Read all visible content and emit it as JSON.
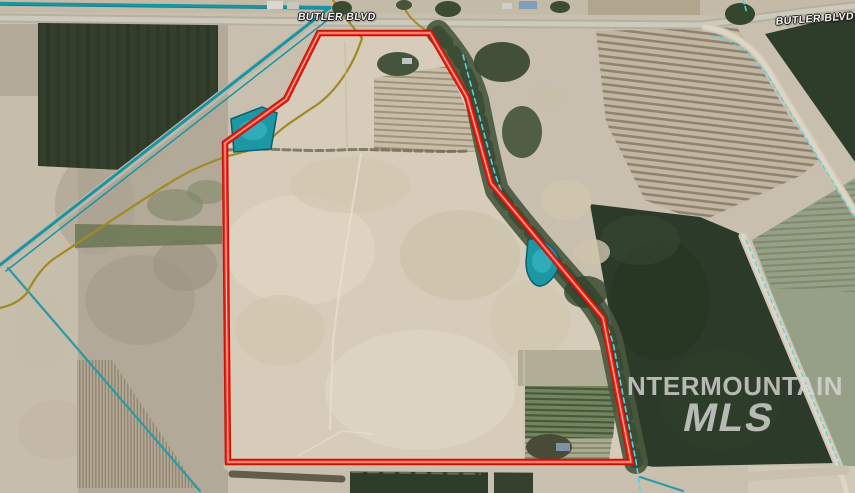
{
  "map": {
    "width": 855,
    "height": 493,
    "road_labels": [
      {
        "text": "BUTLER BLVD",
        "position": "north-west"
      },
      {
        "text": "BUTLER BLVD",
        "position": "north-east"
      }
    ],
    "watermark": {
      "line1": "NTERMOUNTAIN",
      "line2": "MLS"
    },
    "palette": {
      "boundary_red": "#f02718",
      "boundary_red_dark": "#c3140a",
      "boundary_core_light": "#ffcabe",
      "canal_teal": "#1795a3",
      "pond_fill": "#1e97a4",
      "pond_edge": "#0a5f6d",
      "ditch_olive": "#a08a26",
      "creek_dash_cyan": "#55cfe2",
      "parcel_tan": "#d6ccb9",
      "scrub_tan": "#b2a998",
      "dark_field_green": "#2c3a29",
      "road_gray": "#b5b0a2",
      "watermark_gray": "#d6d6d3"
    },
    "boundary": {
      "points": "319,33 430,33 467,97 491,183 603,318 631,462 228,462 225,143 286,99",
      "outer": "#c3140a",
      "mid": "#f02718",
      "core": "#ffcabe"
    },
    "layers": [
      {
        "name": "base-ground",
        "kind": "polygon",
        "points": "0,0 855,0 855,493 0,493",
        "fill": "#c9bfae"
      },
      {
        "name": "scrub-west",
        "kind": "polygon",
        "points": "0,24 228,24 228,493 0,493",
        "fill": "#b2a998"
      },
      {
        "name": "west-smooth-strip",
        "kind": "polygon",
        "points": "0,96 78,96 78,493 0,493",
        "fill": "#c8bfad",
        "opacity": 0.9
      },
      {
        "name": "scrub-mottle",
        "kind": "ellipse",
        "cx": 140,
        "cy": 300,
        "rx": 55,
        "ry": 45,
        "fill": "#a69d8c",
        "opacity": 0.7
      },
      {
        "name": "scrub-mottle",
        "kind": "ellipse",
        "cx": 95,
        "cy": 205,
        "rx": 40,
        "ry": 50,
        "fill": "#aaa190",
        "opacity": 0.6
      },
      {
        "name": "scrub-mottle",
        "kind": "ellipse",
        "cx": 185,
        "cy": 265,
        "rx": 32,
        "ry": 26,
        "fill": "#9b927e",
        "opacity": 0.6
      },
      {
        "name": "scrub-mottle",
        "kind": "ellipse",
        "cx": 55,
        "cy": 430,
        "rx": 38,
        "ry": 30,
        "fill": "#c2b8a4",
        "opacity": 0.7
      },
      {
        "name": "scrub-mottle",
        "kind": "ellipse",
        "cx": 120,
        "cy": 145,
        "rx": 42,
        "ry": 30,
        "fill": "#b0a795",
        "opacity": 0.7
      },
      {
        "name": "scrub-mottle",
        "kind": "ellipse",
        "cx": 40,
        "cy": 330,
        "rx": 30,
        "ry": 40,
        "fill": "#c4bba8",
        "opacity": 0.6
      },
      {
        "name": "top-strip",
        "kind": "polygon",
        "points": "0,0 855,0 855,16 0,12",
        "fill": "#c3baa8"
      },
      {
        "name": "top-farm-field",
        "kind": "polygon",
        "points": "588,0 700,0 700,15 588,15",
        "fill": "#b1a58d"
      },
      {
        "name": "field-upper-left-dark",
        "kind": "polygon",
        "points": "38,23 218,23 218,92 122,170 38,166",
        "fill": "#333f2d"
      },
      {
        "name": "field-upper-left-streaks",
        "kind": "stripes",
        "clip": "38,23 218,23 218,92 122,170 38,166",
        "dir": "v",
        "pitch": 10,
        "slope": 0,
        "color": "#27331f",
        "width": 3,
        "opacity": 0.5
      },
      {
        "name": "field-ne-triangle",
        "kind": "polygon",
        "points": "765,34 855,13 855,162",
        "fill": "#2e3c2a"
      },
      {
        "name": "field-ne-striped",
        "kind": "polygon",
        "points": "596,31 737,27 790,118 822,158 800,176 700,222 645,200 606,122",
        "fill": "#c3b6a0"
      },
      {
        "name": "field-ne-furrows",
        "kind": "stripes",
        "clip": "596,31 737,27 790,118 822,158 800,176 700,222 645,200 606,122",
        "dir": "h",
        "pitch": 7,
        "slope": 0.12,
        "color": "#7b7261",
        "width": 2.5,
        "opacity": 0.75
      },
      {
        "name": "field-east-green",
        "kind": "polygon",
        "points": "752,240 855,178 855,493 847,493",
        "fill": "#96a087"
      },
      {
        "name": "field-east-furrows",
        "kind": "stripes",
        "clip": "752,240 855,180 855,292 772,288",
        "dir": "h",
        "pitch": 6,
        "slope": -0.05,
        "color": "#6e7a5e",
        "width": 2,
        "opacity": 0.6
      },
      {
        "name": "field-center-green",
        "kind": "polygon",
        "points": "590,204 700,217 745,236 838,463 643,467 613,333",
        "fill": "#2c3a29"
      },
      {
        "name": "green-mottle",
        "kind": "ellipse",
        "cx": 660,
        "cy": 300,
        "rx": 50,
        "ry": 60,
        "fill": "#243320",
        "opacity": 0.5
      },
      {
        "name": "green-mottle",
        "kind": "ellipse",
        "cx": 720,
        "cy": 400,
        "rx": 60,
        "ry": 50,
        "fill": "#31402c",
        "opacity": 0.6
      },
      {
        "name": "green-mottle",
        "kind": "ellipse",
        "cx": 640,
        "cy": 240,
        "rx": 40,
        "ry": 25,
        "fill": "#3a4a33",
        "opacity": 0.5
      },
      {
        "name": "parcel-interior",
        "kind": "polygon",
        "points": "319,33 430,33 467,97 491,183 603,318 631,462 228,462 225,143 286,99",
        "fill": "#d6ccb9"
      },
      {
        "name": "parcel-mottle",
        "kind": "ellipse",
        "cx": 300,
        "cy": 250,
        "rx": 75,
        "ry": 55,
        "fill": "#ded5c2",
        "opacity": 0.8
      },
      {
        "name": "parcel-mottle",
        "kind": "ellipse",
        "cx": 420,
        "cy": 390,
        "rx": 95,
        "ry": 60,
        "fill": "#ded5c3",
        "opacity": 0.7
      },
      {
        "name": "parcel-mottle",
        "kind": "ellipse",
        "cx": 460,
        "cy": 255,
        "rx": 60,
        "ry": 45,
        "fill": "#ccc1aa",
        "opacity": 0.7
      },
      {
        "name": "parcel-mottle",
        "kind": "ellipse",
        "cx": 350,
        "cy": 185,
        "rx": 60,
        "ry": 28,
        "fill": "#d0c5ae",
        "opacity": 0.6
      },
      {
        "name": "parcel-mottle",
        "kind": "ellipse",
        "cx": 280,
        "cy": 330,
        "rx": 45,
        "ry": 35,
        "fill": "#cfc4ad",
        "opacity": 0.6
      },
      {
        "name": "parcel-mottle",
        "kind": "ellipse",
        "cx": 530,
        "cy": 320,
        "rx": 40,
        "ry": 40,
        "fill": "#d1c6af",
        "opacity": 0.6
      },
      {
        "name": "parcel-subfield-ne",
        "kind": "polygon",
        "points": "374,78 448,66 484,152 374,152",
        "fill": "#c9bda7"
      },
      {
        "name": "parcel-subfield-ne-furrows",
        "kind": "stripes",
        "clip": "374,78 448,66 484,152 374,152",
        "dir": "h",
        "pitch": 6,
        "slope": 0.05,
        "color": "#948a73",
        "width": 2,
        "opacity": 0.8
      },
      {
        "name": "parcel-subfield-se-gray",
        "kind": "polygon",
        "points": "518,350 612,350 616,386 518,386",
        "fill": "#b2ad96"
      },
      {
        "name": "parcel-subfield-se-green",
        "kind": "polygon",
        "points": "525,386 618,386 613,438 525,438",
        "fill": "#74845f"
      },
      {
        "name": "parcel-subfield-se-green-rows",
        "kind": "stripes",
        "clip": "525,386 618,386 613,438 525,438",
        "dir": "h",
        "pitch": 5.5,
        "slope": 0.02,
        "color": "#3f5236",
        "width": 2.2,
        "opacity": 0.85
      },
      {
        "name": "parcel-subfield-se-lower",
        "kind": "polygon",
        "points": "525,438 612,438 609,461 525,461",
        "fill": "#acaa90"
      },
      {
        "name": "parcel-subfield-se-lower-rows",
        "kind": "stripes",
        "clip": "525,438 612,438 609,461 525,461",
        "dir": "h",
        "pitch": 5,
        "slope": 0,
        "color": "#6d7a58",
        "width": 1.8,
        "opacity": 0.7
      },
      {
        "name": "field-sw-striped",
        "kind": "polygon",
        "points": "77,360 112,360 197,488 77,488",
        "fill": "#b6ab96"
      },
      {
        "name": "field-sw-rows",
        "kind": "stripes",
        "clip": "77,360 112,360 197,488 77,488",
        "dir": "v",
        "pitch": 3.2,
        "slope": 0,
        "color": "#847a66",
        "width": 1.4,
        "opacity": 0.8
      },
      {
        "name": "green-scrub-patch",
        "kind": "ellipse",
        "cx": 175,
        "cy": 205,
        "rx": 28,
        "ry": 16,
        "fill": "#7a8362",
        "opacity": 0.55
      },
      {
        "name": "green-scrub-patch",
        "kind": "ellipse",
        "cx": 207,
        "cy": 192,
        "rx": 20,
        "ry": 12,
        "fill": "#7a8362",
        "opacity": 0.5
      },
      {
        "name": "green-band-west",
        "kind": "polygon",
        "points": "75,224 222,226 222,244 75,248",
        "fill": "#66744f",
        "opacity": 0.8
      },
      {
        "name": "field-south-green-1",
        "kind": "polygon",
        "points": "350,468 488,468 488,493 350,493",
        "fill": "#2e3c2a"
      },
      {
        "name": "field-south-green-2",
        "kind": "polygon",
        "points": "494,469 533,469 533,493 494,493",
        "fill": "#33412e"
      },
      {
        "name": "farmstead-se-corner",
        "kind": "polygon",
        "points": "748,466 855,466 855,493 748,493",
        "fill": "#d1c8b5"
      },
      {
        "name": "butler-blvd-road",
        "kind": "path",
        "d": "M0,18 L330,22 L700,25 C760,18 810,10 855,6",
        "stroke": "#b5b0a2",
        "width": 9
      },
      {
        "name": "butler-blvd-road-center",
        "kind": "path",
        "d": "M0,18 L330,22 L700,25 C760,18 810,10 855,6",
        "stroke": "#cdc9bb",
        "width": 5
      },
      {
        "name": "canal-road-diagonal",
        "kind": "path",
        "d": "M328,10 L0,266",
        "stroke": "#bfb8aa",
        "width": 7
      },
      {
        "name": "road-ne",
        "kind": "path",
        "d": "M705,27 C735,32 758,50 773,78 L855,212",
        "stroke": "#cfc8b6",
        "width": 8
      },
      {
        "name": "road-ne-center",
        "kind": "path",
        "d": "M705,27 C735,32 758,50 773,78 L855,212",
        "stroke": "#ddd6c4",
        "width": 4.5
      },
      {
        "name": "road-east",
        "kind": "path",
        "d": "M743,236 L838,464 L847,493",
        "stroke": "#cfc8b6",
        "width": 9
      },
      {
        "name": "road-east-center",
        "kind": "path",
        "d": "M743,236 L838,464 L847,493",
        "stroke": "#ddd6c4",
        "width": 5
      },
      {
        "name": "road-south",
        "kind": "path",
        "d": "M228,466 L640,469 L700,480 L845,470",
        "stroke": "#c9c1ae",
        "width": 9
      },
      {
        "name": "road-south-tracks",
        "kind": "path",
        "d": "M352,472 L480,474",
        "stroke": "#857e6c",
        "width": 2,
        "dash": "10,6",
        "opacity": 0.7
      },
      {
        "name": "hedgerow-south",
        "kind": "path",
        "d": "M232,474 L342,479",
        "stroke": "#4f4a3b",
        "width": 7,
        "opacity": 0.85
      },
      {
        "name": "canal-north",
        "kind": "path",
        "d": "M0,5 L330,9",
        "stroke": "#0e7280",
        "width": 1.4
      },
      {
        "name": "canal-north-main",
        "kind": "path",
        "d": "M0,3.5 L330,7.5",
        "stroke": "#1795a3",
        "width": 3.2
      },
      {
        "name": "canal-diagonal-1",
        "kind": "path",
        "d": "M328,9 L0,265",
        "stroke": "#1795a3",
        "width": 3
      },
      {
        "name": "canal-diagonal-2",
        "kind": "path",
        "d": "M334,15 L6,271",
        "stroke": "#1795a3",
        "width": 1.5
      },
      {
        "name": "canal-branch-sw",
        "kind": "path",
        "d": "M8,268 L200,491",
        "stroke": "#2b9aa6",
        "width": 2.2
      },
      {
        "name": "ditch-olive-main",
        "kind": "path",
        "d": "M333,0 C342,14 352,26 362,38 C352,70 332,96 312,108 C296,119 282,127 270,140 C258,149 241,153 228,156 C207,163 186,172 168,184 C135,204 95,232 55,258 C40,268 32,284 26,294 C18,303 8,306 0,308",
        "stroke": "#a08a26",
        "width": 2.2
      },
      {
        "name": "ditch-olive-east",
        "kind": "path",
        "d": "M402,0 C404,12 412,20 420,26 C437,38 452,52 461,72 C468,88 472,102 475,116",
        "stroke": "#a08a26",
        "width": 2
      },
      {
        "name": "riparian-corridor",
        "kind": "path",
        "d": "M438,32 C458,55 470,75 477,100 C484,135 490,165 497,190 C520,222 556,262 584,294 C600,312 608,328 612,345 C620,385 628,425 636,462",
        "stroke": "#49593f",
        "width": 24,
        "opacity": 0.92
      },
      {
        "name": "riparian-texture",
        "kind": "path",
        "d": "M438,32 C458,55 470,75 477,100 C484,135 490,165 497,190 C520,222 556,262 584,294 C600,312 608,328 612,345 C620,385 628,425 636,462",
        "stroke": "#35452e",
        "width": 13,
        "dash": "14,11",
        "opacity": 0.7
      },
      {
        "name": "riparian-blob",
        "kind": "ellipse",
        "cx": 502,
        "cy": 62,
        "rx": 28,
        "ry": 20,
        "fill": "#33442c",
        "opacity": 0.9
      },
      {
        "name": "riparian-blob",
        "kind": "ellipse",
        "cx": 522,
        "cy": 132,
        "rx": 20,
        "ry": 26,
        "fill": "#3a4c33",
        "opacity": 0.85
      },
      {
        "name": "riparian-blob",
        "kind": "ellipse",
        "cx": 586,
        "cy": 292,
        "rx": 22,
        "ry": 16,
        "fill": "#33442c",
        "opacity": 0.8
      },
      {
        "name": "sand-gap",
        "kind": "ellipse",
        "cx": 566,
        "cy": 200,
        "rx": 26,
        "ry": 20,
        "fill": "#cfc5ae",
        "opacity": 0.9
      },
      {
        "name": "sand-gap",
        "kind": "ellipse",
        "cx": 592,
        "cy": 252,
        "rx": 18,
        "ry": 13,
        "fill": "#cfc5ae",
        "opacity": 0.8
      },
      {
        "name": "sand-gap",
        "kind": "ellipse",
        "cx": 547,
        "cy": 97,
        "rx": 15,
        "ry": 10,
        "fill": "#c8bea8",
        "opacity": 0.75
      },
      {
        "name": "trees-top",
        "kind": "ellipse",
        "cx": 342,
        "cy": 8,
        "rx": 10,
        "ry": 7,
        "fill": "#3c4c33"
      },
      {
        "name": "trees-top",
        "kind": "ellipse",
        "cx": 448,
        "cy": 9,
        "rx": 13,
        "ry": 8,
        "fill": "#3c4c33"
      },
      {
        "name": "trees-top",
        "kind": "ellipse",
        "cx": 560,
        "cy": 7,
        "rx": 10,
        "ry": 6,
        "fill": "#3c4c33"
      },
      {
        "name": "trees-top",
        "kind": "ellipse",
        "cx": 740,
        "cy": 14,
        "rx": 15,
        "ry": 11,
        "fill": "#35462f"
      },
      {
        "name": "trees-top",
        "kind": "ellipse",
        "cx": 404,
        "cy": 5,
        "rx": 8,
        "ry": 5,
        "fill": "#46543c"
      },
      {
        "name": "building-top",
        "kind": "polygon",
        "points": "267,1 283,1 283,9 267,9",
        "fill": "#d8d8d2"
      },
      {
        "name": "building-top",
        "kind": "polygon",
        "points": "287,2 299,2 299,9 287,9",
        "fill": "#c5c8c2"
      },
      {
        "name": "building-top-blue-roof",
        "kind": "polygon",
        "points": "519,1 537,1 537,9 519,9",
        "fill": "#7e9fba"
      },
      {
        "name": "building-top",
        "kind": "polygon",
        "points": "502,3 512,3 512,9 502,9",
        "fill": "#d0d0c8"
      },
      {
        "name": "creek-dashed",
        "kind": "path",
        "d": "M463,55 C472,90 482,125 489,152 C494,172 499,187 504,196 C530,228 560,262 586,294 C602,314 610,330 614,347 C621,386 629,427 636,461 L640,489",
        "stroke": "#55cfe2",
        "width": 1.6,
        "dash": "5,4"
      },
      {
        "name": "creek-dashed-top",
        "kind": "path",
        "d": "M743,0 L747,13",
        "stroke": "#55cfe2",
        "width": 1.6,
        "dash": "4,3"
      },
      {
        "name": "creek-dashed-ne",
        "kind": "path",
        "d": "M712,36 C740,42 760,60 774,86 L855,218",
        "stroke": "#55cfe2",
        "width": 1.4,
        "dash": "4,4",
        "opacity": 0.9
      },
      {
        "name": "creek-dashed-east",
        "kind": "path",
        "d": "M746,240 L841,468",
        "stroke": "#55cfe2",
        "width": 1.4,
        "dash": "4,4",
        "opacity": 0.9
      },
      {
        "name": "canal-south-short",
        "kind": "path",
        "d": "M640,477 L683,491",
        "stroke": "#2b9aa6",
        "width": 2
      },
      {
        "name": "brush-line",
        "kind": "path",
        "d": "M228,150 C260,147 300,152 340,150 C380,148 430,153 468,151",
        "stroke": "#6e6852",
        "width": 3,
        "dash": "7,4",
        "opacity": 0.8
      },
      {
        "name": "field-edge-faint",
        "kind": "path",
        "d": "M345,42 L347,148",
        "stroke": "#c5bba6",
        "width": 1.5,
        "opacity": 0.7
      },
      {
        "name": "track-faint",
        "kind": "path",
        "d": "M361,154 C352,210 340,280 333,342 L330,430",
        "stroke": "#e8e0d0",
        "width": 2,
        "opacity": 0.75
      },
      {
        "name": "track-faint-2",
        "kind": "path",
        "d": "M298,456 L342,431 L372,434",
        "stroke": "#e8e0d0",
        "width": 1.5,
        "opacity": 0.7
      },
      {
        "name": "field-edge-se",
        "kind": "path",
        "d": "M524,350 L524,460",
        "stroke": "#cdc4b0",
        "width": 1.5,
        "opacity": 0.8
      },
      {
        "name": "farmstead-ne",
        "kind": "ellipse",
        "cx": 398,
        "cy": 64,
        "rx": 21,
        "ry": 12,
        "fill": "#47543d"
      },
      {
        "name": "farmstead-ne-roof",
        "kind": "polygon",
        "points": "402,58 412,58 412,64 402,64",
        "fill": "#ccd2d4",
        "opacity": 0.9
      },
      {
        "name": "farmstead-se",
        "kind": "ellipse",
        "cx": 549,
        "cy": 447,
        "rx": 23,
        "ry": 13,
        "fill": "#4a4a39"
      },
      {
        "name": "farmstead-se-roof",
        "kind": "polygon",
        "points": "556,443 570,443 570,451 556,451",
        "fill": "#7b92a2"
      },
      {
        "name": "pond-northwest",
        "kind": "polygon",
        "points": "231,119 262,107 277,113 271,149 234,152",
        "fill": "#1e97a4",
        "stroke": "#0a5f6d",
        "sw": 1.5
      },
      {
        "name": "pond-northwest-highlight",
        "kind": "ellipse",
        "cx": 253,
        "cy": 130,
        "rx": 14,
        "ry": 10,
        "fill": "#35b2bd",
        "opacity": 0.8
      },
      {
        "name": "pond-east",
        "kind": "path",
        "d": "M528,240 C540,235 556,247 559,259 C561,270 550,284 541,286 C533,287 526,276 526,262 Z",
        "stroke": "#0a5f6d",
        "width": 1.5,
        "fill": "#1e97a4"
      },
      {
        "name": "pond-east-highlight",
        "kind": "ellipse",
        "cx": 542,
        "cy": 261,
        "rx": 10,
        "ry": 12,
        "fill": "#35b2bd",
        "opacity": 0.8
      }
    ]
  }
}
